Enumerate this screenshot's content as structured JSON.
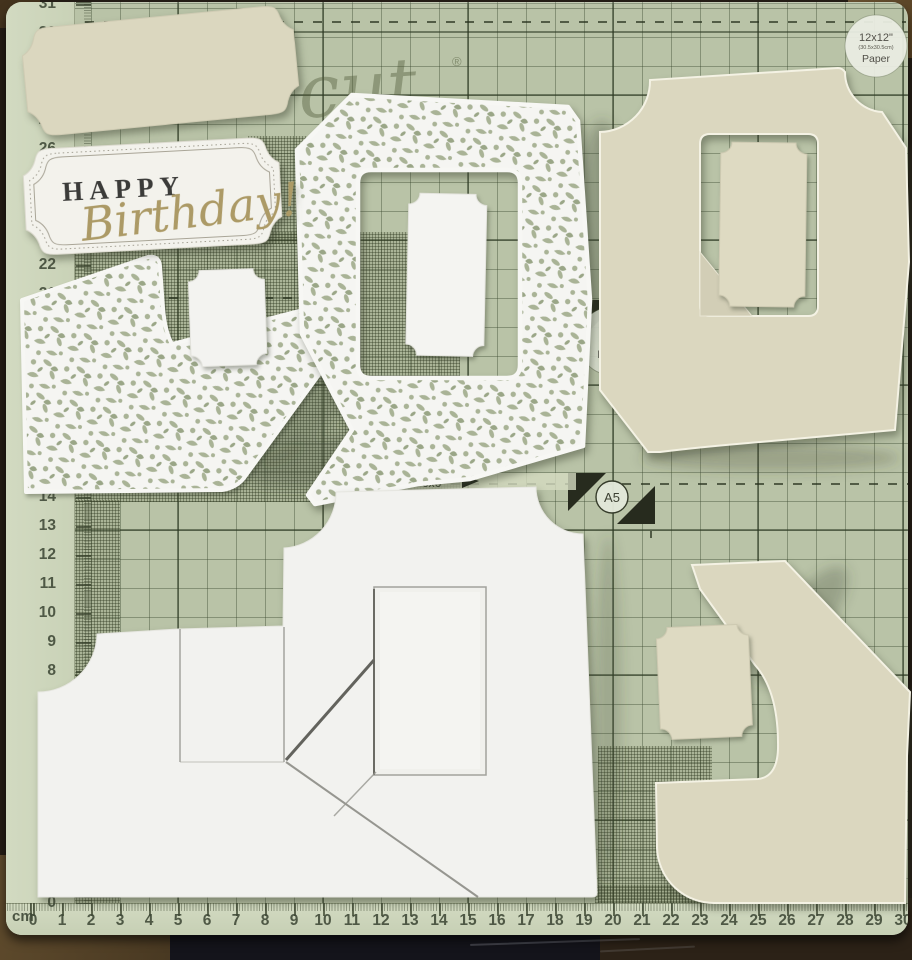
{
  "scene": {
    "description": "Photograph of die-cut card making pieces arranged on a green craft cutting mat",
    "objects": [
      "cream-blank-label",
      "happy-birthday-sentiment-label",
      "lace-corner-die-cut",
      "lace-frame-die-cut",
      "white-ticket-small",
      "white-ticket-large",
      "cream-aperture-card",
      "cream-ticket-large",
      "white-stepper-card-base",
      "cream-stepper-piece",
      "cream-ticket-small"
    ]
  },
  "sentiment": {
    "line1": "HAPPY",
    "line2": "Birthday!"
  },
  "mat": {
    "brand_watermark": "cut",
    "registered_mark": "®",
    "size_markers": {
      "twelve": {
        "line1": "12x12\"",
        "line2": "(30.5x30.5cm)",
        "line3": "Paper"
      },
      "eight": {
        "line1": "8x8\"",
        "line2": "(20.3cm)",
        "line3": "Paper"
      },
      "a5": "A5",
      "seven": "7",
      "six": "6x6\""
    },
    "rulers": {
      "unit_label": "cm",
      "bottom": {
        "numbers": [
          0,
          1,
          2,
          3,
          4,
          5,
          6,
          7,
          8,
          9,
          10,
          11,
          12,
          13,
          14,
          15,
          16,
          17,
          18,
          19,
          20,
          21,
          22,
          23,
          24,
          25,
          26,
          27,
          28,
          29,
          30
        ]
      },
      "left": {
        "numbers": [
          0,
          1,
          2,
          3,
          4,
          5,
          6,
          7,
          8,
          9,
          10,
          11,
          12,
          13,
          14,
          15,
          16,
          17,
          18,
          19,
          20,
          21,
          22,
          23,
          24,
          25,
          26,
          27,
          28,
          29,
          30,
          31
        ]
      }
    },
    "colors": {
      "mat_green": "#b9c3a7",
      "grid_line": "#3a4a2c",
      "ruler_strip": "#cdd5bc",
      "cream_card": "#dbd7bf",
      "white_card": "#f2f2ef",
      "gold_script": "#ac9a66",
      "charcoal_text": "#3b3b39"
    }
  }
}
